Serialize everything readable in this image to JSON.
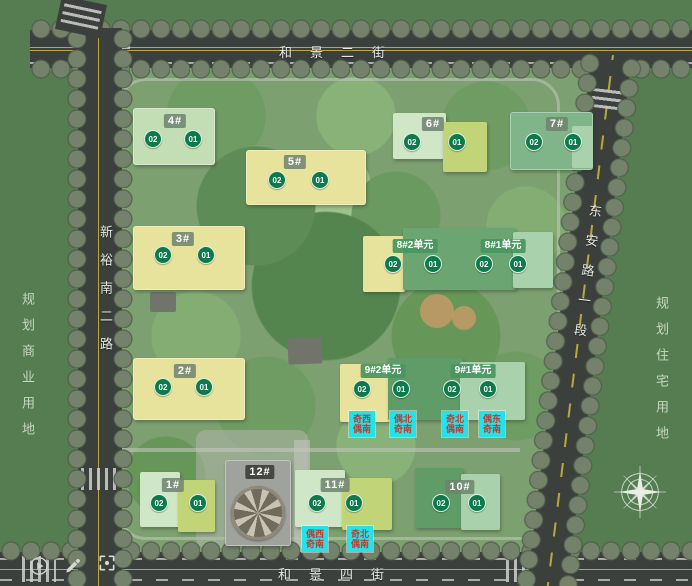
{
  "roads": {
    "top": "和景二街",
    "bottom": "和景四街",
    "left": "新裕南二路",
    "right": "东安路一段"
  },
  "zones": {
    "left": "规划商业用地",
    "right": "规划住宅用地"
  },
  "buildings": [
    {
      "label": "4#",
      "badges": [
        "02",
        "01"
      ]
    },
    {
      "label": "5#",
      "badges": [
        "02",
        "01"
      ]
    },
    {
      "label": "6#",
      "badges": [
        "02",
        "01"
      ]
    },
    {
      "label": "7#",
      "badges": [
        "02",
        "01"
      ]
    },
    {
      "label": "3#",
      "badges": [
        "02",
        "01"
      ]
    },
    {
      "label": "8#2单元",
      "badges": [
        "02",
        "01"
      ]
    },
    {
      "label": "8#1单元",
      "badges": [
        "02",
        "01"
      ]
    },
    {
      "label": "2#",
      "badges": [
        "02",
        "01"
      ]
    },
    {
      "label": "9#2单元",
      "badges": [
        "02",
        "01"
      ]
    },
    {
      "label": "9#1单元",
      "badges": [
        "02",
        "01"
      ]
    },
    {
      "label": "1#",
      "badges": [
        "02",
        "01"
      ]
    },
    {
      "label": "12#",
      "badges": []
    },
    {
      "label": "11#",
      "badges": [
        "02",
        "01"
      ]
    },
    {
      "label": "10#",
      "badges": [
        "02",
        "01"
      ]
    }
  ],
  "orientation_labels": [
    {
      "row1": "奇西",
      "row2": "偶南"
    },
    {
      "row1": "偶北",
      "row2": "奇南"
    },
    {
      "row1": "奇北",
      "row2": "偶南"
    },
    {
      "row1": "偶东",
      "row2": "奇南"
    },
    {
      "row1": "偶西",
      "row2": "奇南"
    },
    {
      "row1": "奇北",
      "row2": "偶南"
    }
  ],
  "icons": {
    "toolbar": [
      "play-icon",
      "pencil-icon",
      "fullscreen-icon"
    ],
    "compass": "compass-rose-icon"
  },
  "colors": {
    "badge_green": "#0d7a4b",
    "unit_label_green": "#489660",
    "building_yellow": "#e7e29c",
    "building_mint": "#cfe7c7",
    "building_yellow_green": "#c2d478",
    "building_green": "#5f9c68",
    "building_pale_jade": "#a9d2ac",
    "cyan_label_bg": "#25e2e9",
    "cyan_label_text": "#bd3c30",
    "road": "#3c403d",
    "grass": "#567c52"
  }
}
